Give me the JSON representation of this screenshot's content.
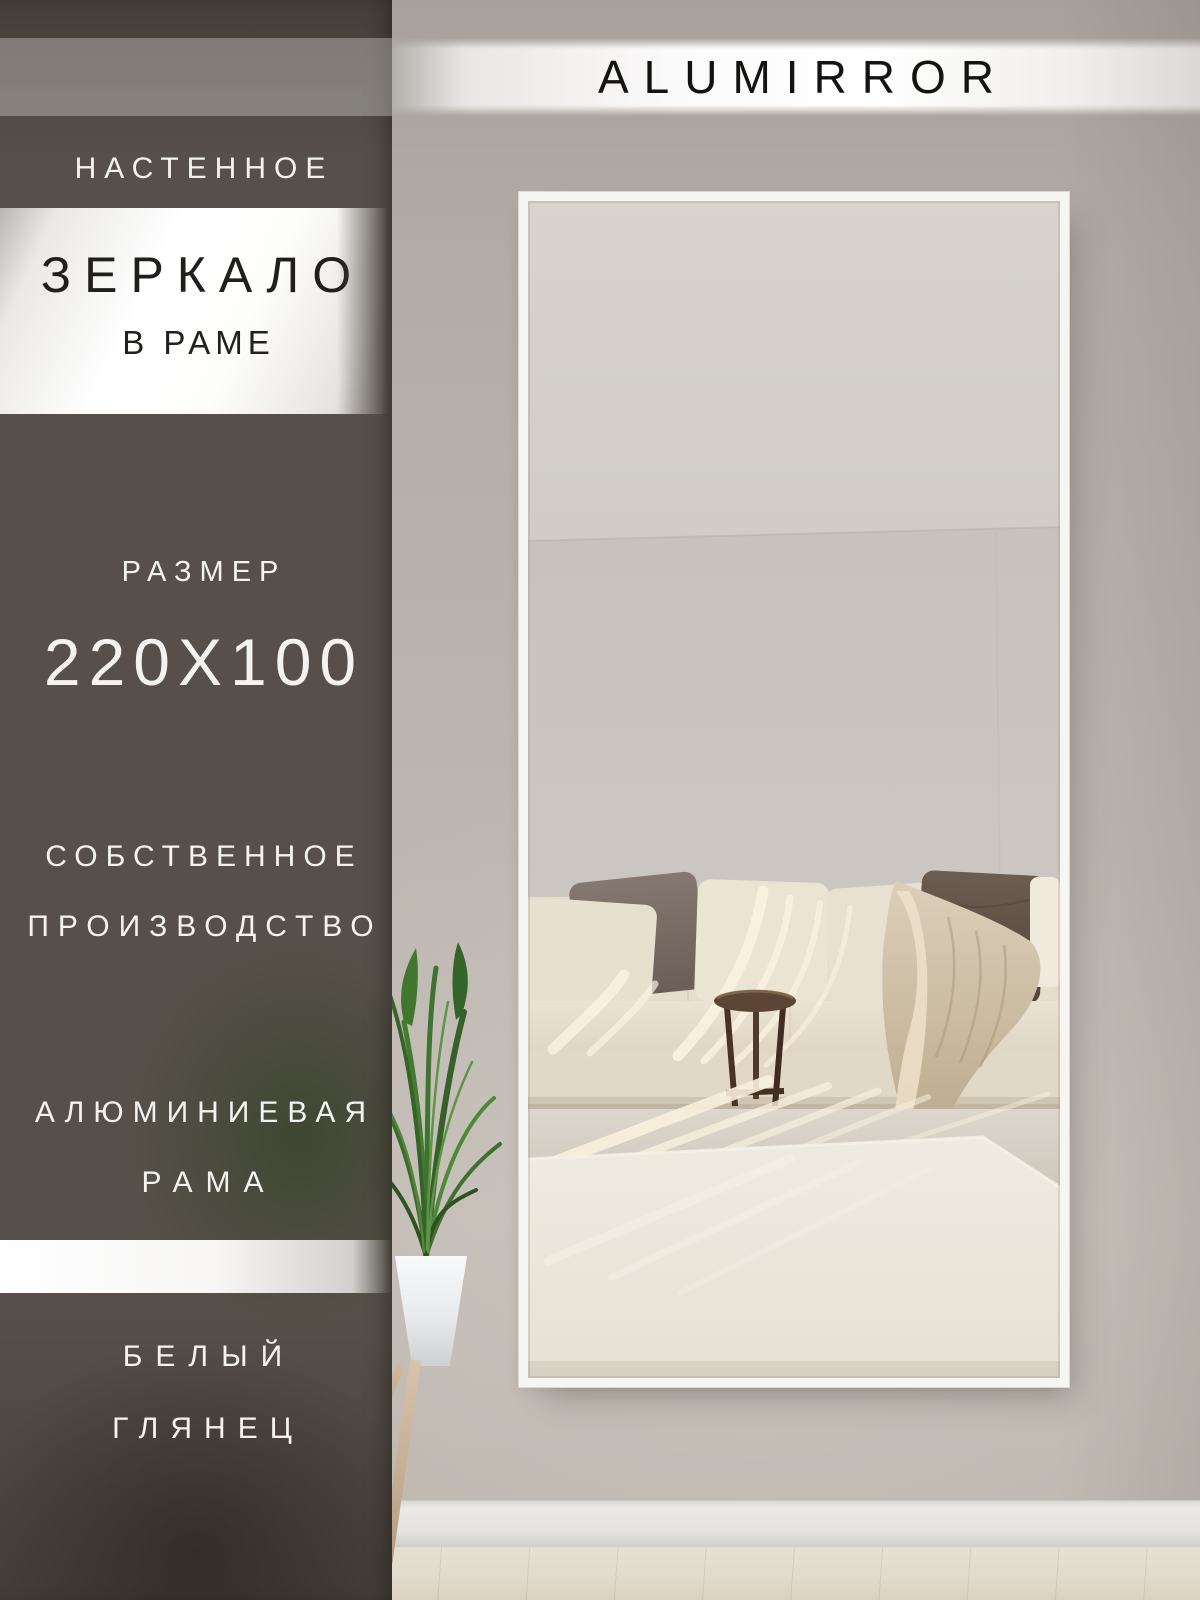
{
  "brand": {
    "name": "ALUMIRROR"
  },
  "sidebar": {
    "type_label": "НАСТЕННОЕ",
    "banner_title": "ЗЕРКАЛО",
    "banner_subtitle": "В РАМЕ",
    "size_label": "РАЗМЕР",
    "size_value": "220Х100",
    "feature_production": [
      "СОБСТВЕННОЕ",
      "ПРОИЗВОДСТВО"
    ],
    "feature_frame": [
      "АЛЮМИНИЕВАЯ",
      "РАМА"
    ],
    "finish": [
      "БЕЛЫЙ",
      "ГЛЯНЕЦ"
    ]
  },
  "colors": {
    "sidebar_overlay": "#57504a",
    "banner_white": "#ffffff",
    "text_light": "#f5f3f0",
    "text_dark": "#1c1b19",
    "wall": "#bcb5af",
    "mirror_frame": "#f6f5f2",
    "sofa_cream": "#e8e0cf",
    "pillow_mauve": "#7b6e67",
    "pillow_brown": "#5e5044",
    "throw_beige": "#cfc1a9",
    "table_wood": "#5a4232",
    "rug": "#eae5da",
    "plant_green": "#3c6c2d"
  }
}
